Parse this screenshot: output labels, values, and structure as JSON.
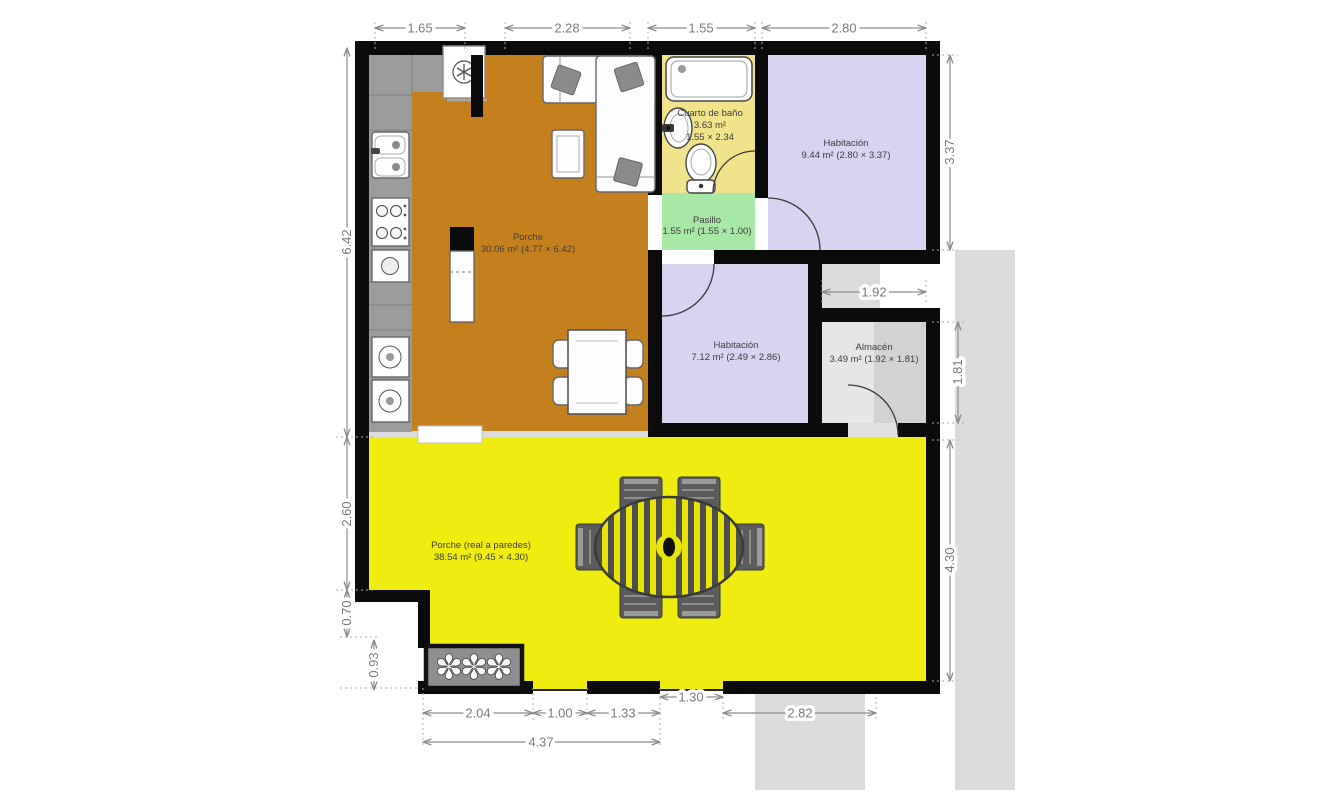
{
  "colors": {
    "wall": "#0b0b0b",
    "porche_interior": "#c4801c",
    "bathroom": "#f1e38b",
    "pasillo": "#a6e8a4",
    "habitacion": "#d7d3f1",
    "almacen_light": "#e6e6e6",
    "almacen_dark": "#d2d2d2",
    "porche_exterior": "#f0ec10",
    "terrain": "#dcdcdc",
    "counter": "#9c9c9c"
  },
  "rooms": {
    "porche_interior": {
      "name": "Porche",
      "area": "30.06 m² (4.77 × 6.42)"
    },
    "cuarto_de_bano": {
      "name": "Cuarto de baño",
      "area": "3.63 m²",
      "size": "1.55 × 2.34"
    },
    "pasillo": {
      "name": "Pasillo",
      "area": "1.55 m² (1.55 × 1.00)"
    },
    "habitacion_1": {
      "name": "Habitación",
      "area": "9.44 m² (2.80 × 3.37)"
    },
    "habitacion_2": {
      "name": "Habitación",
      "area": "7.12 m² (2.49 × 2.86)"
    },
    "almacen": {
      "name": "Almacén",
      "area": "3.49 m² (1.92 × 1.81)"
    },
    "porche_exterior": {
      "name": "Porche (real a paredes)",
      "area": "38.54 m² (9.45 × 4.30)"
    }
  },
  "dims": {
    "top": [
      "1.65",
      "2.28",
      "1.55",
      "2.80"
    ],
    "left": [
      "6.42",
      "2.60",
      "0.70",
      "0.93"
    ],
    "right": [
      "3.37",
      "1.81",
      "4.30"
    ],
    "inner": [
      "1.92"
    ],
    "bottom": [
      "2.04",
      "1.00",
      "1.33",
      "1.30",
      "2.82",
      "4.37"
    ]
  }
}
